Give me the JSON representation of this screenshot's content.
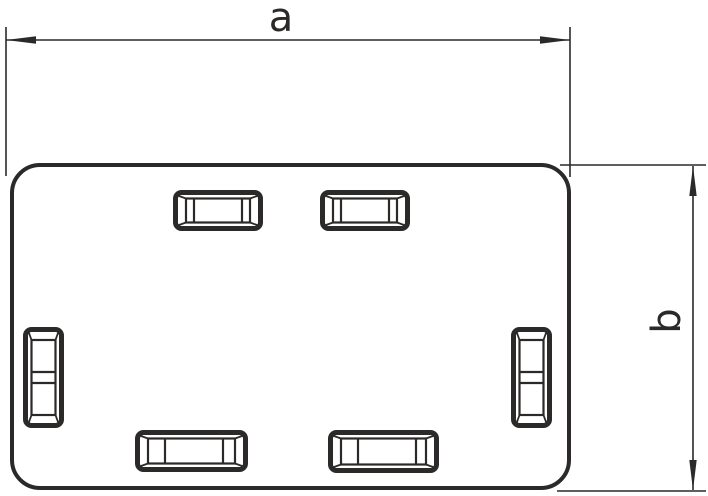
{
  "drawing": {
    "kind": "technical-dimension-drawing",
    "colors": {
      "line": "#2b2a29",
      "background": "#ffffff"
    },
    "dimensions": {
      "width": {
        "label": "a"
      },
      "height": {
        "label": "b"
      }
    },
    "part": {
      "outline": {
        "x": 10,
        "y": 163,
        "width": 561,
        "height": 327,
        "corner_radius": 30
      },
      "slots": [
        {
          "id": "top-left",
          "orientation": "horizontal",
          "x": 173,
          "y": 190,
          "width": 90,
          "height": 41,
          "dividers": [
            21,
            69
          ]
        },
        {
          "id": "top-right",
          "orientation": "horizontal",
          "x": 320,
          "y": 190,
          "width": 90,
          "height": 41,
          "dividers": [
            21,
            69
          ]
        },
        {
          "id": "side-left",
          "orientation": "vertical",
          "x": 23,
          "y": 327,
          "width": 41,
          "height": 101,
          "dividers": [
            45,
            56
          ]
        },
        {
          "id": "side-right",
          "orientation": "vertical",
          "x": 511,
          "y": 327,
          "width": 41,
          "height": 101,
          "dividers": [
            45,
            56
          ]
        },
        {
          "id": "bottom-left",
          "orientation": "horizontal",
          "x": 135,
          "y": 430,
          "width": 113,
          "height": 42,
          "dividers": [
            30,
            88
          ]
        },
        {
          "id": "bottom-right",
          "orientation": "horizontal",
          "x": 328,
          "y": 430,
          "width": 111,
          "height": 43,
          "dividers": [
            30,
            88
          ]
        }
      ]
    }
  }
}
